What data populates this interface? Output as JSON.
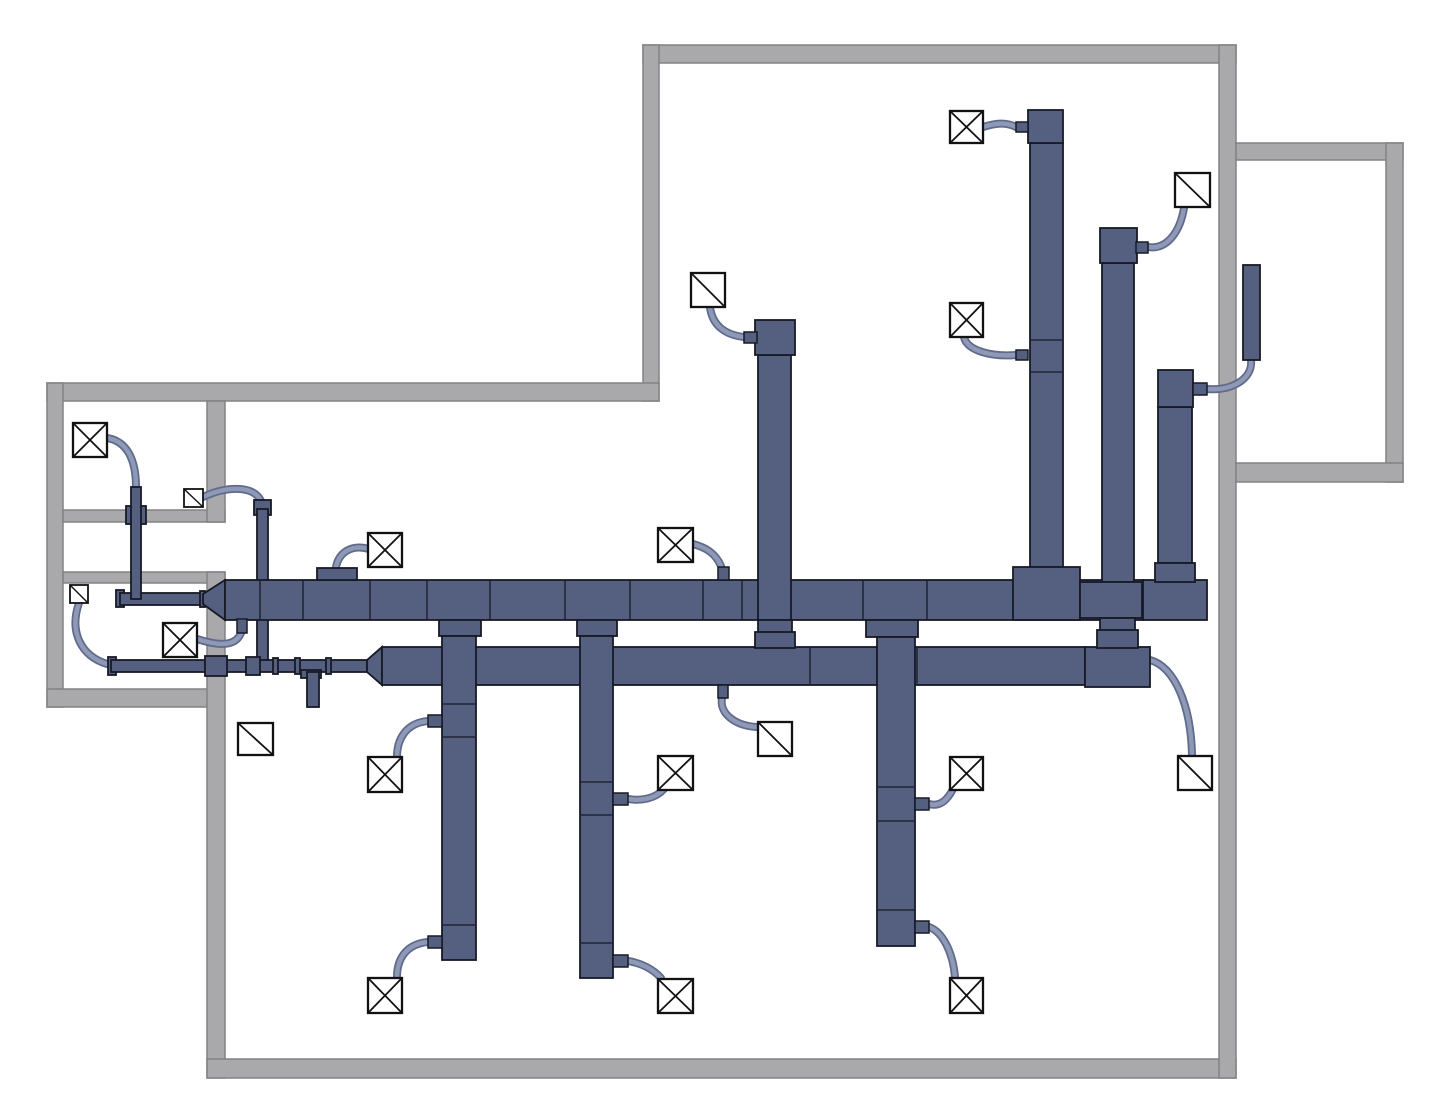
{
  "canvas": {
    "width": 1451,
    "height": 1100,
    "background": "#ffffff"
  },
  "colors": {
    "wall_fill": "#a9a9ab",
    "wall_stroke": "#828285",
    "duct_fill": "#556080",
    "duct_stroke": "#171a25",
    "flex_outer": "#5f6a8c",
    "flex_inner": "#8e99b6",
    "box_fill": "#ffffff",
    "box_stroke": "#121212"
  },
  "walls": [
    {
      "x": 643,
      "y": 45,
      "w": 593,
      "h": 18
    },
    {
      "x": 643,
      "y": 45,
      "w": 16,
      "h": 356
    },
    {
      "x": 47,
      "y": 383,
      "w": 612,
      "h": 18
    },
    {
      "x": 47,
      "y": 383,
      "w": 16,
      "h": 324
    },
    {
      "x": 63,
      "y": 510,
      "w": 162,
      "h": 12
    },
    {
      "x": 63,
      "y": 572,
      "w": 162,
      "h": 11
    },
    {
      "x": 47,
      "y": 689,
      "w": 163,
      "h": 18
    },
    {
      "x": 207,
      "y": 401,
      "w": 18,
      "h": 121
    },
    {
      "x": 207,
      "y": 572,
      "w": 18,
      "h": 506
    },
    {
      "x": 207,
      "y": 1059,
      "w": 1029,
      "h": 19
    },
    {
      "x": 1219,
      "y": 45,
      "w": 17,
      "h": 1033
    },
    {
      "x": 1236,
      "y": 143,
      "w": 167,
      "h": 17
    },
    {
      "x": 1386,
      "y": 143,
      "w": 17,
      "h": 339
    },
    {
      "x": 1236,
      "y": 463,
      "w": 167,
      "h": 19
    }
  ],
  "flex_runs": [
    {
      "path": "M107,438 C126,441 136,458 136,487"
    },
    {
      "path": "M203,497 C224,487 253,484 261,501"
    },
    {
      "path": "M79,603 C69,632 81,656 107,664"
    },
    {
      "path": "M197,639 C216,645 235,648 241,633"
    },
    {
      "path": "M369,549 C352,544 339,552 336,567"
    },
    {
      "path": "M693,544 C704,547 715,552 721,566"
    },
    {
      "path": "M710,307 C712,325 725,335 744,337"
    },
    {
      "path": "M983,127 C996,123 1006,122 1016,127"
    },
    {
      "path": "M964,337 C967,351 992,357 1016,355"
    },
    {
      "path": "M1148,247 C1167,250 1180,232 1184,208"
    },
    {
      "path": "M1251,360 C1253,379 1232,391 1207,389"
    },
    {
      "path": "M1150,660 C1175,667 1191,706 1192,755"
    },
    {
      "path": "M722,698 C719,714 736,726 757,727"
    },
    {
      "path": "M428,721 C406,723 397,739 397,757"
    },
    {
      "path": "M428,942 C406,944 397,959 397,977"
    },
    {
      "path": "M628,799 C641,801 655,799 664,789"
    },
    {
      "path": "M628,961 C641,963 653,969 661,978"
    },
    {
      "path": "M929,804 C939,807 947,801 953,789"
    },
    {
      "path": "M929,927 C943,932 953,953 955,977"
    }
  ],
  "duct_shapes": [
    {
      "t": "rect",
      "n": "thin-duct-end-cap",
      "x": 116,
      "y": 590,
      "w": 8,
      "h": 17
    },
    {
      "t": "rect",
      "n": "thin-supply-duct",
      "x": 120,
      "y": 593,
      "w": 84,
      "h": 12
    },
    {
      "t": "rect",
      "n": "wall-crossing-collar",
      "x": 126,
      "y": 506,
      "w": 20,
      "h": 18
    },
    {
      "t": "rect",
      "n": "room-riser-duct",
      "x": 131,
      "y": 487,
      "w": 10,
      "h": 112
    },
    {
      "t": "rect",
      "n": "riser-top-cap",
      "x": 254,
      "y": 500,
      "w": 17,
      "h": 15
    },
    {
      "t": "rect",
      "n": "riser-duct",
      "x": 257,
      "y": 509,
      "w": 11,
      "h": 153
    },
    {
      "t": "rect",
      "n": "thin-duct-end-cap",
      "x": 108,
      "y": 657,
      "w": 8,
      "h": 18
    },
    {
      "t": "rect",
      "n": "thin-return-duct",
      "x": 111,
      "y": 660,
      "w": 256,
      "h": 12
    },
    {
      "t": "rect",
      "n": "wall-crossing-collar",
      "x": 205,
      "y": 656,
      "w": 22,
      "h": 20
    },
    {
      "t": "rect",
      "n": "duct-joint-collar",
      "x": 246,
      "y": 657,
      "w": 14,
      "h": 18
    },
    {
      "t": "rect",
      "n": "duct-joint-tick",
      "x": 273,
      "y": 658,
      "w": 5,
      "h": 16
    },
    {
      "t": "rect",
      "n": "duct-joint-tick",
      "x": 295,
      "y": 658,
      "w": 5,
      "h": 16
    },
    {
      "t": "rect",
      "n": "duct-joint-tick",
      "x": 326,
      "y": 658,
      "w": 5,
      "h": 16
    },
    {
      "t": "rect",
      "n": "tee-fitting",
      "x": 301,
      "y": 670,
      "w": 20,
      "h": 8
    },
    {
      "t": "rect",
      "n": "drop-duct-stem",
      "x": 307,
      "y": 672,
      "w": 12,
      "h": 35
    },
    {
      "t": "poly",
      "n": "lower-trunk-taper",
      "pts": "367,660 382,647 382,685 367,672"
    },
    {
      "t": "rect",
      "n": "lower-supply-trunk",
      "x": 382,
      "y": 647,
      "w": 703,
      "h": 38
    },
    {
      "t": "rect",
      "n": "lower-trunk-elbow",
      "x": 1085,
      "y": 647,
      "w": 65,
      "h": 40
    },
    {
      "t": "line",
      "n": "duct-seam",
      "x1": 810,
      "y1": 648,
      "x2": 810,
      "y2": 684
    },
    {
      "t": "line",
      "n": "duct-seam",
      "x1": 917,
      "y1": 648,
      "x2": 917,
      "y2": 684
    },
    {
      "t": "rect",
      "n": "trunk-tip-plate",
      "x": 200,
      "y": 591,
      "w": 5,
      "h": 16
    },
    {
      "t": "poly",
      "n": "main-trunk-reducer",
      "pts": "203,594 225,580 225,620 203,604"
    },
    {
      "t": "rect",
      "n": "main-supply-trunk",
      "x": 225,
      "y": 580,
      "w": 918,
      "h": 40
    },
    {
      "t": "rect",
      "n": "trunk-top-takeoff",
      "x": 317,
      "y": 568,
      "w": 40,
      "h": 12
    },
    {
      "t": "rect",
      "n": "main-trunk-end-block",
      "x": 1143,
      "y": 580,
      "w": 64,
      "h": 40
    },
    {
      "t": "line",
      "n": "duct-seam",
      "x1": 260,
      "y1": 581,
      "x2": 260,
      "y2": 619
    },
    {
      "t": "line",
      "n": "duct-seam",
      "x1": 303,
      "y1": 581,
      "x2": 303,
      "y2": 619
    },
    {
      "t": "line",
      "n": "duct-seam",
      "x1": 370,
      "y1": 581,
      "x2": 370,
      "y2": 619
    },
    {
      "t": "line",
      "n": "duct-seam",
      "x1": 427,
      "y1": 581,
      "x2": 427,
      "y2": 619
    },
    {
      "t": "line",
      "n": "duct-seam",
      "x1": 490,
      "y1": 581,
      "x2": 490,
      "y2": 619
    },
    {
      "t": "line",
      "n": "duct-seam",
      "x1": 565,
      "y1": 581,
      "x2": 565,
      "y2": 619
    },
    {
      "t": "line",
      "n": "duct-seam",
      "x1": 630,
      "y1": 581,
      "x2": 630,
      "y2": 619
    },
    {
      "t": "line",
      "n": "duct-seam",
      "x1": 703,
      "y1": 581,
      "x2": 703,
      "y2": 619
    },
    {
      "t": "line",
      "n": "duct-seam",
      "x1": 742,
      "y1": 581,
      "x2": 742,
      "y2": 619
    },
    {
      "t": "line",
      "n": "duct-seam",
      "x1": 863,
      "y1": 581,
      "x2": 863,
      "y2": 619
    },
    {
      "t": "line",
      "n": "duct-seam",
      "x1": 927,
      "y1": 581,
      "x2": 927,
      "y2": 619
    },
    {
      "t": "rect",
      "n": "riser-duct-body",
      "x": 1030,
      "y": 143,
      "w": 33,
      "h": 424
    },
    {
      "t": "rect",
      "n": "riser-duct-head",
      "x": 1028,
      "y": 110,
      "w": 35,
      "h": 33
    },
    {
      "t": "rect",
      "n": "riser-trunk-collar",
      "x": 1013,
      "y": 567,
      "w": 67,
      "h": 53
    },
    {
      "t": "line",
      "n": "duct-seam",
      "x1": 1031,
      "y1": 340,
      "x2": 1062,
      "y2": 340
    },
    {
      "t": "line",
      "n": "duct-seam",
      "x1": 1031,
      "y1": 372,
      "x2": 1062,
      "y2": 372
    },
    {
      "t": "rect",
      "n": "riser-duct-body",
      "x": 1102,
      "y": 263,
      "w": 32,
      "h": 319
    },
    {
      "t": "rect",
      "n": "riser-duct-head",
      "x": 1100,
      "y": 228,
      "w": 37,
      "h": 35
    },
    {
      "t": "rect",
      "n": "riser-trunk-fitting",
      "x": 1080,
      "y": 582,
      "w": 62,
      "h": 36
    },
    {
      "t": "rect",
      "n": "riser-neck",
      "x": 1100,
      "y": 618,
      "w": 35,
      "h": 14
    },
    {
      "t": "rect",
      "n": "riser-step-collar",
      "x": 1097,
      "y": 630,
      "w": 41,
      "h": 18
    },
    {
      "t": "rect",
      "n": "riser-duct-body",
      "x": 1158,
      "y": 407,
      "w": 34,
      "h": 156
    },
    {
      "t": "rect",
      "n": "riser-duct-head",
      "x": 1158,
      "y": 370,
      "w": 35,
      "h": 37
    },
    {
      "t": "rect",
      "n": "riser-trunk-collar",
      "x": 1155,
      "y": 563,
      "w": 40,
      "h": 19
    },
    {
      "t": "rect",
      "n": "riser-duct-body",
      "x": 758,
      "y": 355,
      "w": 33,
      "h": 265
    },
    {
      "t": "rect",
      "n": "riser-duct-head",
      "x": 755,
      "y": 320,
      "w": 40,
      "h": 35
    },
    {
      "t": "rect",
      "n": "riser-neck",
      "x": 758,
      "y": 620,
      "w": 34,
      "h": 13
    },
    {
      "t": "rect",
      "n": "riser-step-collar",
      "x": 755,
      "y": 632,
      "w": 40,
      "h": 16
    },
    {
      "t": "rect",
      "n": "branch-trunk-collar",
      "x": 439,
      "y": 620,
      "w": 42,
      "h": 16
    },
    {
      "t": "rect",
      "n": "branch-duct",
      "x": 442,
      "y": 636,
      "w": 34,
      "h": 324
    },
    {
      "t": "line",
      "n": "duct-seam",
      "x1": 443,
      "y1": 704,
      "x2": 475,
      "y2": 704
    },
    {
      "t": "line",
      "n": "duct-seam",
      "x1": 443,
      "y1": 737,
      "x2": 475,
      "y2": 737
    },
    {
      "t": "line",
      "n": "duct-seam",
      "x1": 443,
      "y1": 925,
      "x2": 475,
      "y2": 925
    },
    {
      "t": "rect",
      "n": "branch-trunk-collar",
      "x": 577,
      "y": 620,
      "w": 40,
      "h": 16
    },
    {
      "t": "rect",
      "n": "branch-duct",
      "x": 580,
      "y": 636,
      "w": 33,
      "h": 342
    },
    {
      "t": "line",
      "n": "duct-seam",
      "x1": 581,
      "y1": 782,
      "x2": 612,
      "y2": 782
    },
    {
      "t": "line",
      "n": "duct-seam",
      "x1": 581,
      "y1": 815,
      "x2": 612,
      "y2": 815
    },
    {
      "t": "line",
      "n": "duct-seam",
      "x1": 581,
      "y1": 943,
      "x2": 612,
      "y2": 943
    },
    {
      "t": "rect",
      "n": "branch-trunk-collar",
      "x": 866,
      "y": 620,
      "w": 52,
      "h": 17
    },
    {
      "t": "rect",
      "n": "branch-duct",
      "x": 877,
      "y": 637,
      "w": 38,
      "h": 309
    },
    {
      "t": "line",
      "n": "duct-seam",
      "x1": 878,
      "y1": 787,
      "x2": 914,
      "y2": 787
    },
    {
      "t": "line",
      "n": "duct-seam",
      "x1": 878,
      "y1": 821,
      "x2": 914,
      "y2": 821
    },
    {
      "t": "line",
      "n": "duct-seam",
      "x1": 878,
      "y1": 910,
      "x2": 914,
      "y2": 910
    },
    {
      "t": "rect",
      "n": "room-duct-bar",
      "x": 1243,
      "y": 265,
      "w": 17,
      "h": 95
    }
  ],
  "stubs": [
    {
      "x": 1016,
      "y": 122,
      "w": 12,
      "h": 10
    },
    {
      "x": 1016,
      "y": 350,
      "w": 12,
      "h": 10
    },
    {
      "x": 1136,
      "y": 242,
      "w": 12,
      "h": 11
    },
    {
      "x": 1193,
      "y": 383,
      "w": 14,
      "h": 12
    },
    {
      "x": 744,
      "y": 332,
      "w": 13,
      "h": 11
    },
    {
      "x": 718,
      "y": 567,
      "w": 11,
      "h": 13
    },
    {
      "x": 237,
      "y": 619,
      "w": 10,
      "h": 14
    },
    {
      "x": 718,
      "y": 685,
      "w": 10,
      "h": 13
    },
    {
      "x": 428,
      "y": 715,
      "w": 14,
      "h": 12
    },
    {
      "x": 428,
      "y": 936,
      "w": 14,
      "h": 12
    },
    {
      "x": 613,
      "y": 793,
      "w": 15,
      "h": 12
    },
    {
      "x": 613,
      "y": 955,
      "w": 15,
      "h": 12
    },
    {
      "x": 915,
      "y": 798,
      "w": 14,
      "h": 12
    },
    {
      "x": 915,
      "y": 921,
      "w": 14,
      "h": 12
    }
  ],
  "diffusers": [
    {
      "type": "x",
      "x": 73,
      "y": 423,
      "w": 34,
      "h": 34
    },
    {
      "type": "x",
      "x": 163,
      "y": 623,
      "w": 34,
      "h": 34
    },
    {
      "type": "x",
      "x": 368,
      "y": 533,
      "w": 34,
      "h": 34
    },
    {
      "type": "x",
      "x": 658,
      "y": 528,
      "w": 35,
      "h": 34
    },
    {
      "type": "x",
      "x": 950,
      "y": 111,
      "w": 33,
      "h": 32
    },
    {
      "type": "x",
      "x": 950,
      "y": 303,
      "w": 33,
      "h": 34
    },
    {
      "type": "x",
      "x": 368,
      "y": 757,
      "w": 34,
      "h": 35
    },
    {
      "type": "x",
      "x": 658,
      "y": 756,
      "w": 35,
      "h": 34
    },
    {
      "type": "x",
      "x": 950,
      "y": 757,
      "w": 33,
      "h": 33
    },
    {
      "type": "x",
      "x": 368,
      "y": 978,
      "w": 34,
      "h": 35
    },
    {
      "type": "x",
      "x": 658,
      "y": 979,
      "w": 35,
      "h": 34
    },
    {
      "type": "x",
      "x": 950,
      "y": 978,
      "w": 33,
      "h": 35
    },
    {
      "type": "d",
      "x": 184,
      "y": 489,
      "w": 19,
      "h": 18
    },
    {
      "type": "d",
      "x": 70,
      "y": 585,
      "w": 18,
      "h": 18
    },
    {
      "type": "d",
      "x": 238,
      "y": 723,
      "w": 35,
      "h": 32
    },
    {
      "type": "d",
      "x": 691,
      "y": 273,
      "w": 34,
      "h": 34
    },
    {
      "type": "d",
      "x": 758,
      "y": 722,
      "w": 34,
      "h": 34
    },
    {
      "type": "d",
      "x": 1175,
      "y": 173,
      "w": 35,
      "h": 34
    },
    {
      "type": "d",
      "x": 1178,
      "y": 756,
      "w": 34,
      "h": 34
    }
  ]
}
